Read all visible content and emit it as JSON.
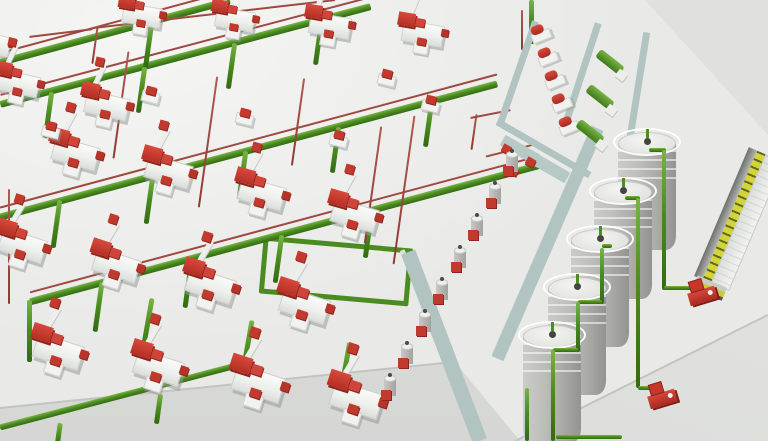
{
  "scene": {
    "colors": {
      "floor": "#e9eae7",
      "pipe_green": "#4b8d20",
      "pipe_red": "#9d4b43",
      "machine_red": "#c23a2e",
      "machine_white": "#f2f3f1",
      "wall_teal": "#b2c4c2",
      "wall_edge": "#d6e2e0",
      "silo_gray": "#b0b1ad",
      "truck_yellow": "#d8d23a",
      "truck_green": "#54701d"
    },
    "machines": [
      [
        143,
        14,
        10,
        0.85
      ],
      [
        236,
        18,
        10,
        0.85
      ],
      [
        331,
        24,
        10,
        0.9
      ],
      [
        424,
        32,
        10,
        0.9
      ],
      [
        -8,
        42,
        13,
        0.85
      ],
      [
        20,
        82,
        13,
        0.9
      ],
      [
        108,
        104,
        13,
        0.95
      ],
      [
        77,
        152,
        16,
        1
      ],
      [
        170,
        170,
        16,
        1
      ],
      [
        263,
        192,
        16,
        1
      ],
      [
        356,
        214,
        16,
        1
      ],
      [
        24,
        244,
        18,
        1
      ],
      [
        118,
        264,
        18,
        1
      ],
      [
        212,
        284,
        18,
        1.05
      ],
      [
        306,
        304,
        18,
        1.05
      ],
      [
        60,
        350,
        18,
        1.05
      ],
      [
        160,
        366,
        18,
        1.05
      ],
      [
        260,
        382,
        18,
        1.1
      ],
      [
        358,
        398,
        18,
        1.1
      ]
    ],
    "satellites": [
      [
        152,
        95
      ],
      [
        246,
        117
      ],
      [
        340,
        139
      ],
      [
        52,
        130
      ],
      [
        388,
        78
      ],
      [
        432,
        104
      ]
    ],
    "pipes_main": [
      [
        115,
        31,
        238,
        -15.1,
        7,
        1
      ],
      [
        185,
        55,
        383,
        -14.8,
        7,
        1
      ],
      [
        248,
        150,
        515,
        -15,
        7,
        1
      ],
      [
        285,
        233,
        528,
        -15,
        7,
        1
      ],
      [
        120,
        396,
        248,
        -14.7,
        6,
        0
      ]
    ],
    "drops_green": [
      [
        148,
        46,
        44,
        8
      ],
      [
        48,
        115,
        46,
        8
      ],
      [
        141,
        90,
        46,
        8
      ],
      [
        231,
        66,
        46,
        8
      ],
      [
        318,
        43,
        44,
        8
      ],
      [
        56,
        224,
        48,
        8
      ],
      [
        149,
        200,
        48,
        8
      ],
      [
        242,
        175,
        48,
        8
      ],
      [
        335,
        150,
        46,
        8
      ],
      [
        428,
        125,
        44,
        8
      ],
      [
        98,
        307,
        50,
        8
      ],
      [
        188,
        283,
        50,
        8
      ],
      [
        278,
        259,
        48,
        8
      ],
      [
        368,
        235,
        46,
        8
      ],
      [
        146,
        330,
        64,
        10
      ],
      [
        246,
        352,
        64,
        10
      ],
      [
        344,
        372,
        60,
        10
      ],
      [
        58,
        436,
        26,
        8
      ],
      [
        158,
        409,
        30,
        8
      ],
      [
        29,
        331,
        62,
        0
      ],
      [
        531,
        22,
        44,
        0
      ]
    ],
    "drops_red": [
      [
        95,
        45,
        38,
        8
      ],
      [
        121,
        105,
        108,
        8
      ],
      [
        208,
        142,
        132,
        8
      ],
      [
        298,
        122,
        88,
        8
      ],
      [
        373,
        185,
        118,
        8
      ],
      [
        404,
        190,
        150,
        8
      ],
      [
        474,
        132,
        36,
        8
      ],
      [
        9,
        246,
        115,
        0
      ],
      [
        522,
        30,
        40,
        0
      ]
    ],
    "red_lines": [
      [
        214,
        14,
        244,
        -6.6
      ],
      [
        61,
        33,
        64,
        -7
      ],
      [
        490,
        114,
        41,
        -11
      ],
      [
        512,
        150,
        54,
        -14
      ]
    ],
    "green_loop": [
      336,
      271,
      150,
      58,
      -15
    ],
    "walls": [
      [
        543,
        240,
        251,
        4,
        -66.5,
        "edge"
      ],
      [
        547,
        243,
        251,
        13,
        -66.5,
        "main"
      ],
      [
        438,
        344,
        202,
        5,
        69.2,
        "edge"
      ],
      [
        444,
        346,
        202,
        15,
        69.2,
        "main"
      ],
      [
        518,
        72,
        108,
        7,
        -71,
        "main"
      ],
      [
        581,
        76,
        112,
        7,
        -72,
        "main"
      ],
      [
        635,
        106,
        150,
        7,
        -81,
        "main"
      ],
      [
        543,
        148,
        107,
        7,
        30,
        "main"
      ],
      [
        520,
        150,
        40,
        12,
        30,
        "plat"
      ],
      [
        550,
        168,
        40,
        12,
        30,
        "plat"
      ]
    ],
    "red_bits": [
      [
        506,
        149,
        9,
        8,
        30
      ],
      [
        530,
        162,
        9,
        8,
        30
      ],
      [
        514,
        171,
        8,
        7,
        30
      ]
    ],
    "enclosure_units": [
      [
        541,
        32
      ],
      [
        548,
        55
      ],
      [
        555,
        78
      ],
      [
        562,
        101
      ],
      [
        569,
        124
      ]
    ],
    "chutes": [
      [
        610,
        62
      ],
      [
        600,
        97
      ],
      [
        590,
        132
      ]
    ],
    "mixers": [
      [
        512,
        162
      ],
      [
        495,
        194
      ],
      [
        477,
        226
      ],
      [
        460,
        258
      ],
      [
        442,
        290
      ],
      [
        425,
        322
      ],
      [
        407,
        354
      ],
      [
        390,
        386
      ]
    ],
    "silos": [
      [
        647,
        143
      ],
      [
        623,
        192
      ],
      [
        600,
        240
      ],
      [
        577,
        288
      ],
      [
        552,
        336
      ]
    ],
    "silo_pipes": [
      [
        657,
        150,
        17,
        0
      ],
      [
        664,
        220,
        140,
        90
      ],
      [
        681,
        288,
        34,
        0
      ],
      [
        632,
        198,
        15,
        0
      ],
      [
        638,
        293,
        190,
        90
      ],
      [
        648,
        388,
        20,
        0
      ],
      [
        607,
        246,
        10,
        0
      ],
      [
        602,
        276,
        56,
        90
      ],
      [
        590,
        302,
        24,
        0
      ],
      [
        578,
        327,
        50,
        90
      ],
      [
        565,
        350,
        25,
        0
      ],
      [
        553,
        395,
        91,
        90
      ],
      [
        527,
        414,
        53,
        90
      ],
      [
        589,
        437,
        66,
        0
      ]
    ],
    "pumps": [
      [
        703,
        291
      ],
      [
        663,
        394
      ]
    ],
    "truck": [
      739,
      219,
      140,
      38,
      113
    ],
    "curbs": [
      [
        227,
        385,
        458,
        -5.8
      ],
      [
        641,
        378,
        283,
        -26.5
      ]
    ]
  }
}
